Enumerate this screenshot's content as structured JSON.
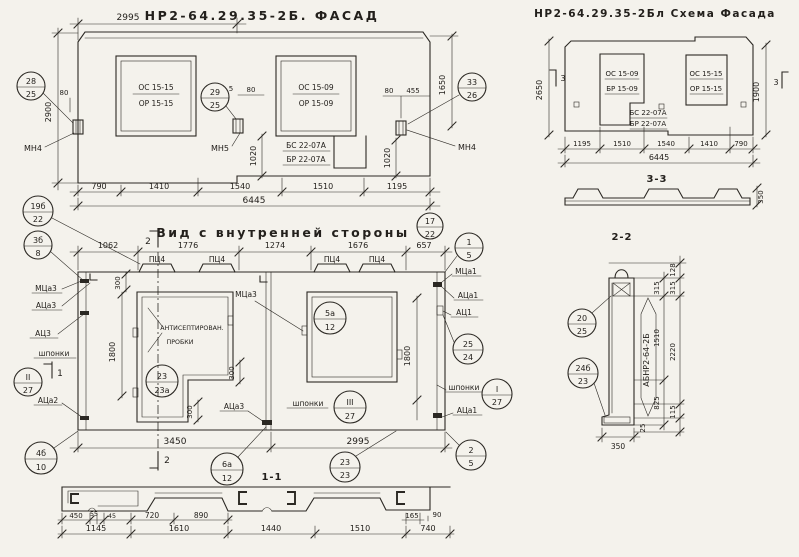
{
  "facade": {
    "title": "НР2-64.29.35-2Б. ФАСАД",
    "d2995": "2995",
    "d2900": "2900",
    "d1650": "1650",
    "d80l": "80",
    "d5": "5",
    "d80m": "80",
    "d80r": "80",
    "d455": "455",
    "d1020l": "1020",
    "d1020r": "1020",
    "w1a": "ОС 15-15",
    "w1b": "ОР 15-15",
    "w2a": "ОС 15-09",
    "w2b": "ОР 15-09",
    "bsa": "БС 22-07А",
    "bsb": "БР 22-07А",
    "mn4l": "МН4",
    "mn5": "МН5",
    "mn4r": "МН4",
    "c28t": "28",
    "c28b": "25",
    "c29t": "29",
    "c29b": "25",
    "c33t": "33",
    "c33b": "26",
    "bd": [
      "790",
      "1410",
      "1540",
      "1510",
      "1195"
    ],
    "total": "6445"
  },
  "schema": {
    "title": "НР2-64.29.35-2Бл  Схема Фасада",
    "d2650": "2650",
    "d1900": "1900",
    "m3l": "3",
    "m3r": "3",
    "w1a": "ОС 15-09",
    "w1b": "БР 15-09",
    "w2a": "ОС 15-15",
    "w2b": "ОР 15-15",
    "bsa": "БС 22-07А",
    "bsb": "БР 22-07А",
    "bd": [
      "1195",
      "1510",
      "1540",
      "1410",
      "790"
    ],
    "total": "6445",
    "s33": "3-3",
    "d350": "350"
  },
  "inner": {
    "title": "Вид с внутренней стороны",
    "m2t": "2",
    "m2b": "2",
    "m1": "1",
    "td": [
      "1062",
      "1776",
      "1274",
      "1676",
      "657"
    ],
    "pc1": "ПЦ4",
    "pc2": "ПЦ4",
    "pc3": "ПЦ4",
    "pc4": "ПЦ4",
    "mca3": "МЦа3",
    "aca3": "АЦа3",
    "ac3": "АЦ3",
    "shpl": "шпонки",
    "aca2": "АЦа2",
    "mca3m": "МЦа3",
    "aca3b": "АЦа3",
    "plug1": "АНТИСЕПТИРОВАН.",
    "plug2": "ПРОБКИ",
    "d300a": "300",
    "d300b": "300",
    "d300c": "300",
    "d1800l": "1800",
    "d1800r": "1800",
    "mca1": "МЦа1",
    "aca1": "АЦа1",
    "ac1": "АЦ1",
    "shpr": "шпонки",
    "aca1b": "АЦа1",
    "shpm": "шпонки",
    "d3450": "3450",
    "d2995": "2995",
    "c19t": "19б",
    "c19b": "22",
    "c3t": "3б",
    "c3b": "8",
    "cIIt": "II",
    "cIIb": "27",
    "c4t": "4б",
    "c4b": "10",
    "c17t": "17",
    "c17b": "22",
    "c1t": "1",
    "c1b": "5",
    "c25t": "25",
    "c25b": "24",
    "cIt": "I",
    "cIb": "27",
    "c2t": "2",
    "c2b": "5",
    "c23t": "23",
    "c23bb": "23",
    "c6t": "6а",
    "c6b": "12",
    "c5t": "5а",
    "c5b": "12",
    "c23at": "23",
    "c23ab": "23а",
    "cIIIt": "III",
    "cIIIb": "27"
  },
  "s11": {
    "title": "1-1",
    "r1": [
      "450",
      "55",
      "45",
      "720",
      "890"
    ],
    "d165": "165",
    "d90": "90",
    "r2": [
      "1145",
      "1610",
      "1440",
      "1510",
      "740"
    ]
  },
  "s22": {
    "title": "2-2",
    "mark": "АБНР2-64-2Б",
    "c20t": "20",
    "c20b": "25",
    "c24t": "24б",
    "c24b": "23",
    "d128": "128",
    "d315a": "315",
    "d315b": "315",
    "d1510": "1510",
    "d2220": "2220",
    "d825": "825",
    "d115": "115",
    "d25": "25",
    "d350": "350"
  }
}
